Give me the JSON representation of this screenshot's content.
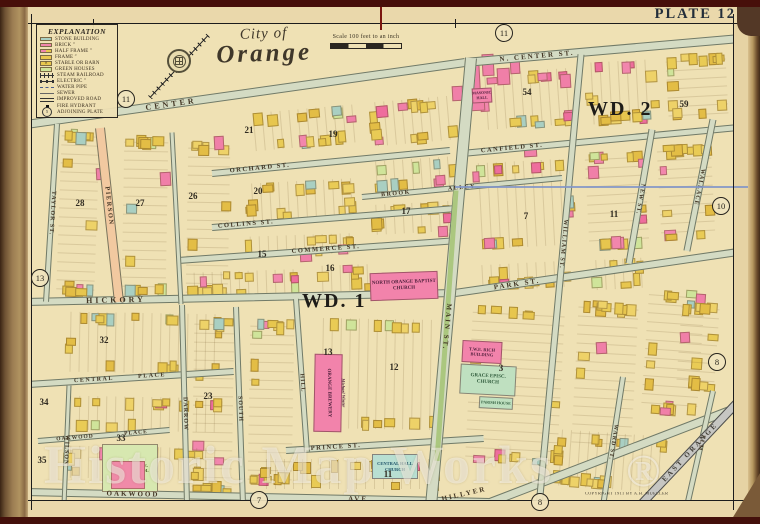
{
  "plate_label": "PLATE 12",
  "title": {
    "line1": "City of",
    "line2": "Orange"
  },
  "scale_text": "Scale 100 feet to an inch",
  "legend": {
    "title": "EXPLANATION",
    "items": [
      {
        "icon": "stone-swatch",
        "label": "STONE BUILDING"
      },
      {
        "icon": "brick-swatch",
        "label": "BRICK ″"
      },
      {
        "icon": "half-frame-swatch",
        "label": "HALF FRAME ″"
      },
      {
        "icon": "frame-swatch",
        "label": "FRAME ″"
      },
      {
        "icon": "stable-swatch",
        "label": "STABLE OR BARN"
      },
      {
        "icon": "greenhouse-swatch",
        "label": "GREEN HOUSES"
      },
      {
        "icon": "steam-railroad-line",
        "label": "STEAM RAILROAD"
      },
      {
        "icon": "electric-line",
        "label": "ELECTRIC ″"
      },
      {
        "icon": "water-pipe-line",
        "label": "WATER PIPE"
      },
      {
        "icon": "sewer-line",
        "label": "SEWER"
      },
      {
        "icon": "improved-road-line",
        "label": "IMPROVED ROAD"
      },
      {
        "icon": "fire-hydrant-dot",
        "label": "FIRE HYDRANT"
      },
      {
        "icon": "adjoining-plate-circle",
        "label": "ADJOINING PLATE",
        "symbol_number": "5"
      }
    ]
  },
  "wards": [
    {
      "label": "WD. 2"
    },
    {
      "label": "WD. 1"
    }
  ],
  "streets": [
    {
      "id": "center-west",
      "labels": [
        "CENTER"
      ]
    },
    {
      "id": "center-east",
      "labels": [
        "N. CENTER ST."
      ]
    },
    {
      "id": "orchard",
      "labels": [
        "ORCHARD ST."
      ]
    },
    {
      "id": "brook-alley",
      "labels": [
        "BROOK",
        "ALLEY"
      ]
    },
    {
      "id": "canfield",
      "labels": [
        "CANFIELD ST."
      ]
    },
    {
      "id": "collins",
      "labels": [
        "COLLINS ST."
      ]
    },
    {
      "id": "commerce",
      "labels": [
        "COMMERCE ST."
      ]
    },
    {
      "id": "hickory",
      "labels": [
        "HICKORY"
      ]
    },
    {
      "id": "park",
      "labels": [
        "PARK ST."
      ]
    },
    {
      "id": "central-place",
      "labels": [
        "CENTRAL",
        "PLACE"
      ]
    },
    {
      "id": "oakwood-place",
      "labels": [
        "OAKWOOD",
        "PLACE"
      ]
    },
    {
      "id": "prince",
      "labels": [
        "PRINCE ST."
      ]
    },
    {
      "id": "oakwood-ave",
      "labels": [
        "OAKWOOD",
        "AVE."
      ]
    },
    {
      "id": "hillyer",
      "labels": []
    },
    {
      "id": "taylor",
      "labels": [
        "TAYLOR ST."
      ]
    },
    {
      "id": "pierson",
      "labels": [
        "PIERSON"
      ]
    },
    {
      "id": "cross-street",
      "labels": []
    },
    {
      "id": "wilson",
      "labels": [
        "WILSON"
      ]
    },
    {
      "id": "darrow",
      "labels": [
        "DARROW"
      ]
    },
    {
      "id": "south",
      "labels": [
        "SOUTH"
      ]
    },
    {
      "id": "hill",
      "labels": [
        "HILL"
      ]
    },
    {
      "id": "main",
      "labels": [
        "MAIN ST."
      ]
    },
    {
      "id": "william",
      "labels": [
        "WILLIAM ST."
      ]
    },
    {
      "id": "new",
      "labels": [
        "NEW ST."
      ]
    },
    {
      "id": "wallace",
      "labels": [
        "WALLACE"
      ]
    },
    {
      "id": "ward",
      "labels": [
        "WARD ST."
      ]
    },
    {
      "id": "elm",
      "labels": [
        "ELM"
      ]
    }
  ],
  "free_labels": [
    {
      "text": "HILLYER"
    },
    {
      "text": "EAST ORANGE"
    }
  ],
  "adjoining_plate_numbers": [
    "5",
    "11",
    "11",
    "13",
    "10",
    "8",
    "7",
    "8"
  ],
  "block_numbers": [
    "54",
    "59",
    "21",
    "19",
    "17",
    "20",
    "26",
    "27",
    "28",
    "15",
    "16",
    "13",
    "7",
    "11",
    "12",
    "3",
    "11",
    "32",
    "23",
    "34",
    "33",
    "35"
  ],
  "landmarks": [
    {
      "name": "NORTH ORANGE BAPTIST CHURCH"
    },
    {
      "name": "ORANGE BREWERY",
      "sub": "Michael Winter"
    },
    {
      "name": "T.W.E. RICH BUILDING"
    },
    {
      "name": "GRACE EPISC. CHURCH"
    },
    {
      "name": "PARISH HOUSE"
    },
    {
      "name": "CENTRAL HALL CHURCH"
    },
    {
      "name": "OAKWOOD AVE. PUBLIC SCHOOL"
    },
    {
      "name": "MASONIC HALL"
    }
  ],
  "watermark": {
    "text": "Historic Map Works",
    "mark": "®"
  },
  "copyright": "COPYRIGHT 1911 BY A.H. MUELLER",
  "colors": {
    "parchment": "#ead8ab",
    "map_bg": "#efe1b4",
    "street": "#d4dbc3",
    "frame_yellow": "#e7c64e",
    "brick_pink": "#f286ad",
    "stone_teal": "#a9cfc2",
    "greenhouse": "#cfe49a",
    "main_median": "#abc77f",
    "plate_text": "#232e3a",
    "cover_maroon": "#470f0a"
  }
}
